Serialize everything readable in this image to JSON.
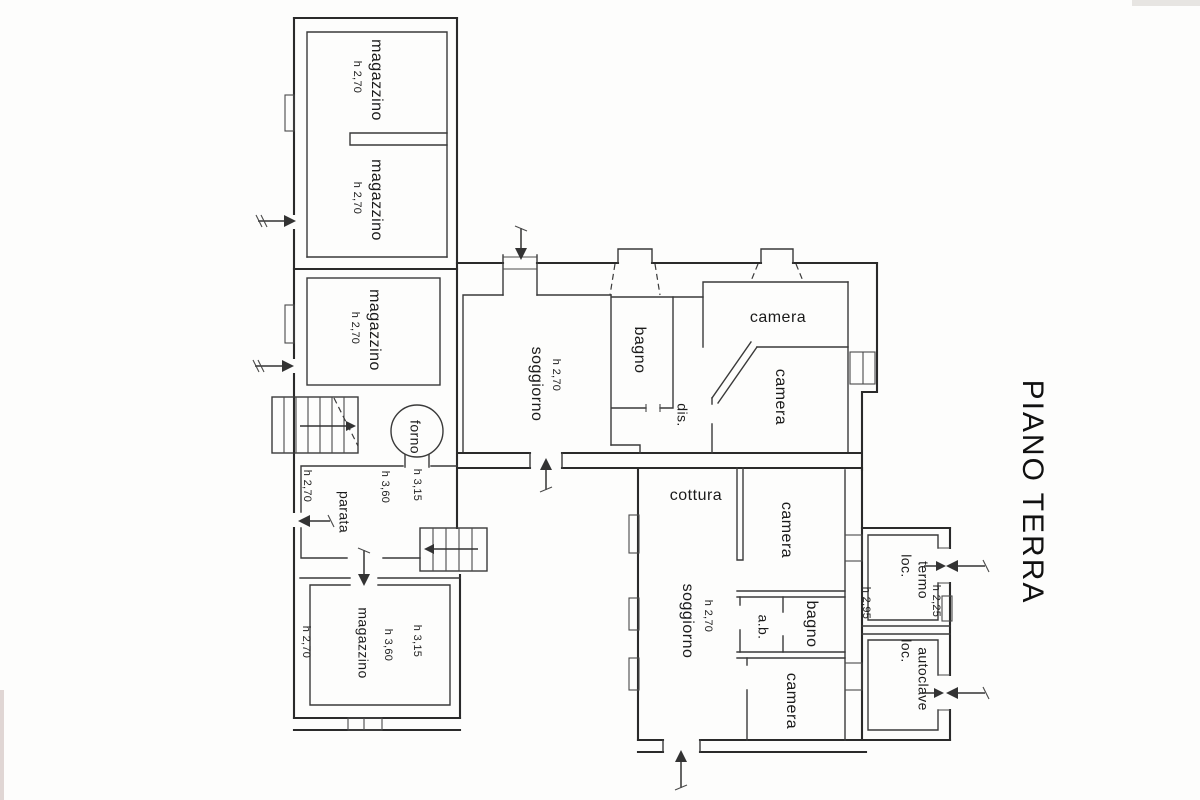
{
  "title": "PIANO TERRA",
  "rooms": {
    "magazzino1": {
      "name": "magazzino",
      "h": "h 2,70"
    },
    "magazzino2": {
      "name": "magazzino",
      "h": "h 2,70"
    },
    "magazzino3": {
      "name": "magazzino",
      "h": "h 2,70"
    },
    "magazzino4": {
      "name": "magazzino",
      "h": "h 2,70",
      "h2": "h 3,60",
      "h3": "h 3,15"
    },
    "parata": {
      "name": "parata",
      "h": "h 2,70",
      "h2": "h 3,60",
      "h3": "h 3,15"
    },
    "forno": {
      "name": "forno"
    },
    "soggiorno1": {
      "name": "soggiorno",
      "h": "h 2,70"
    },
    "bagno1": {
      "name": "bagno"
    },
    "dis": {
      "name": "dis."
    },
    "camera1": {
      "name": "camera"
    },
    "camera2": {
      "name": "camera"
    },
    "cottura": {
      "name": "cottura"
    },
    "camera3": {
      "name": "camera"
    },
    "soggiorno2": {
      "name": "soggiorno",
      "h": "h 2,70"
    },
    "ab": {
      "name": "a.b."
    },
    "bagno2": {
      "name": "bagno"
    },
    "camera4": {
      "name": "camera"
    },
    "locTermo": {
      "l1": "loc.",
      "l2": "termo",
      "h": "h 2,25",
      "h2": "h 2,95"
    },
    "locAutoclave": {
      "l1": "loc.",
      "l2": "autoclave"
    }
  }
}
